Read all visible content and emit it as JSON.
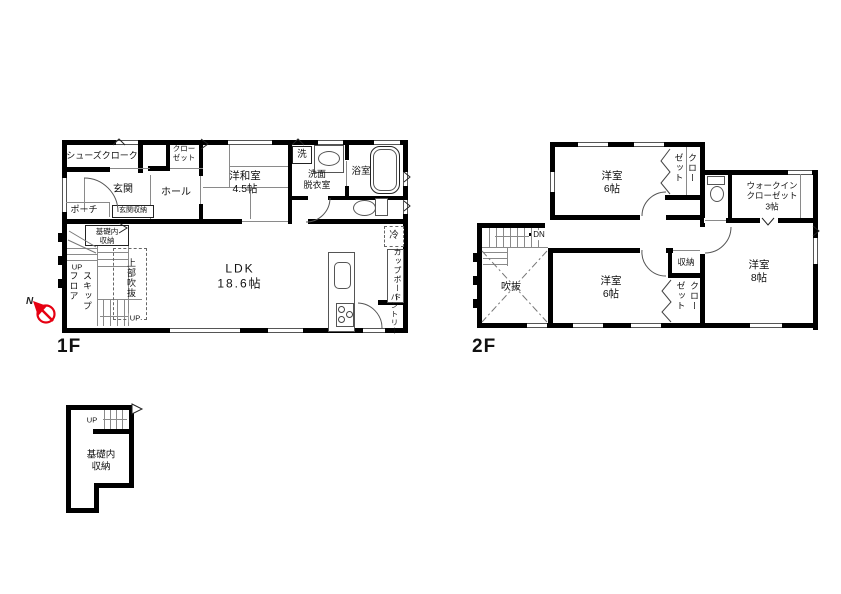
{
  "f1": {
    "title": "1F",
    "shoe_closet": "シューズクローク",
    "closet": "クロー\nゼット",
    "entrance": "玄関",
    "entrance_storage": "玄関収納",
    "hall": "ホール",
    "porch": "ポーチ",
    "japanese_room": "洋和室\n4.5帖",
    "washer": "洗",
    "washroom": "洗面\n脱衣室",
    "bathroom": "浴室",
    "foundation_storage": "基礎内\n収納",
    "up_left": "UP",
    "skip_floor": "スキップフロア",
    "upper_void": "上部吹抜",
    "up_stairs": "UP",
    "ldk": "LDK\n18.6帖",
    "refrigerator": "冷",
    "cupboard": "カップボード",
    "pantry": "パントリー"
  },
  "f2": {
    "title": "2F",
    "bedroom_north": "洋室\n6帖",
    "closet_north": "クローゼット",
    "walk_in_closet": "ウォークイン\nクローゼット\n3帖",
    "down": "DN",
    "void": "吹抜",
    "bedroom_south": "洋室\n6帖",
    "storage": "収納",
    "closet_south": "クローゼット",
    "bedroom_east": "洋室\n8帖"
  },
  "basement": {
    "up": "UP",
    "foundation_storage": "基礎内\n収納"
  },
  "compass": {
    "north": "N"
  }
}
